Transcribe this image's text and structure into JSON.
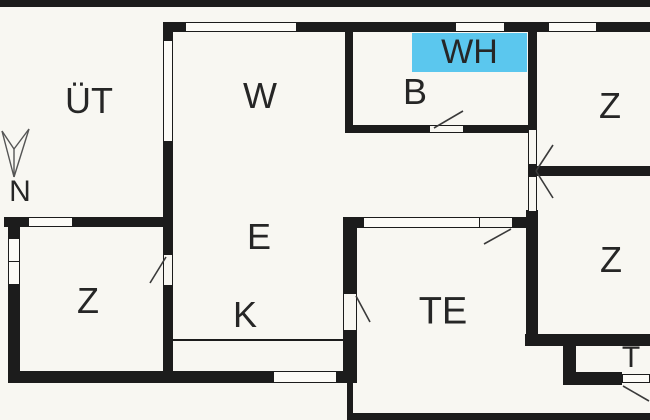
{
  "title": "apartment-floor-plan",
  "colors": {
    "wall": "#1c1c1c",
    "background": "#f8f7f2",
    "highlight": "#5bc7ee",
    "text": "#262626"
  },
  "compass": {
    "label": "N",
    "icon": "north-arrow-icon",
    "direction": "down"
  },
  "rooms": {
    "ut": {
      "label": "ÜT"
    },
    "w": {
      "label": "W"
    },
    "b": {
      "label": "B"
    },
    "wh": {
      "label": "WH",
      "highlighted": true
    },
    "z_top_right": {
      "label": "Z"
    },
    "z_left": {
      "label": "Z"
    },
    "e": {
      "label": "E"
    },
    "k": {
      "label": "K"
    },
    "te": {
      "label": "TE"
    },
    "z_bottom_right": {
      "label": "Z"
    },
    "t": {
      "label": "T"
    }
  }
}
